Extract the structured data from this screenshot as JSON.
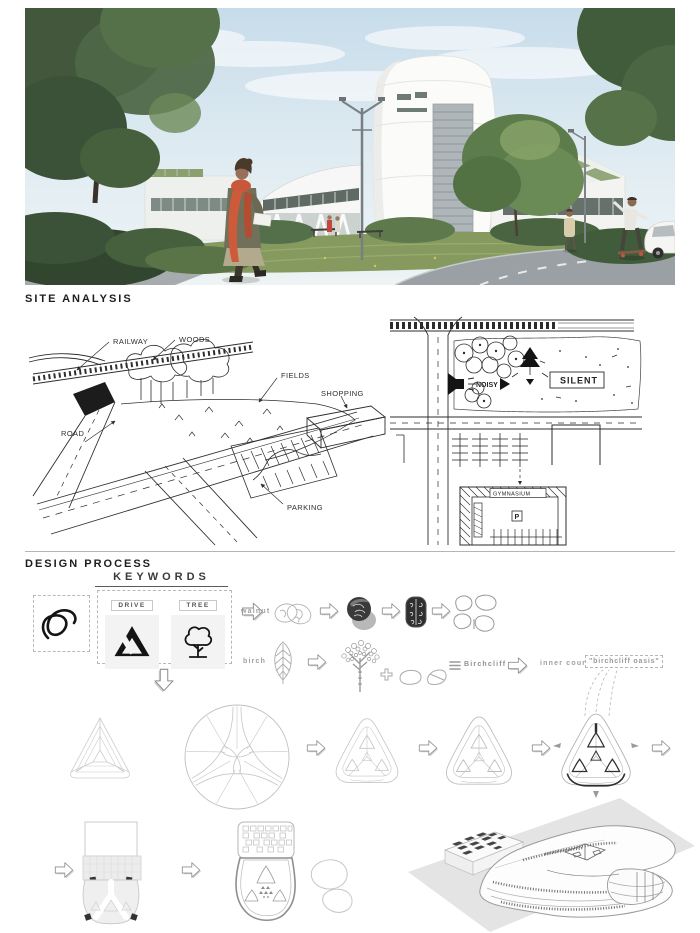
{
  "site_analysis": {
    "heading": "SITE ANALYSIS",
    "axon_labels": {
      "railway": "RAILWAY",
      "woods": "WOODS",
      "fields": "FIELDS",
      "shopping": "SHOPPING",
      "road": "ROAD",
      "parking": "PARKING"
    },
    "plan_labels": {
      "noisy": "NOISY",
      "silent": "SILENT",
      "gymnasium": "GYMNASIUM",
      "parking_p": "P"
    }
  },
  "design_process": {
    "heading": "DESIGN PROCESS",
    "keywords": {
      "title": "KEYWORDS",
      "items": [
        {
          "label": "DRIVE",
          "icon": "google-drive-icon"
        },
        {
          "label": "TREE",
          "icon": "tree-icon"
        }
      ],
      "side_icon": "adobe-acrobat-icon"
    },
    "flow": {
      "walnut_label": "walnut",
      "birch_label": "birch",
      "plus": "+",
      "birchcliff_label": "Birchcliff",
      "inner_courts_label": "inner courts:",
      "oasis_label": "\"birchcliff oasis\""
    }
  },
  "colors": {
    "sketch_ink": "#2e2e2e",
    "light_line": "#c4c4c4",
    "scarf_accent": "#cd5a38",
    "foliage": "#4e6847",
    "sky": "#cfe2ec"
  }
}
